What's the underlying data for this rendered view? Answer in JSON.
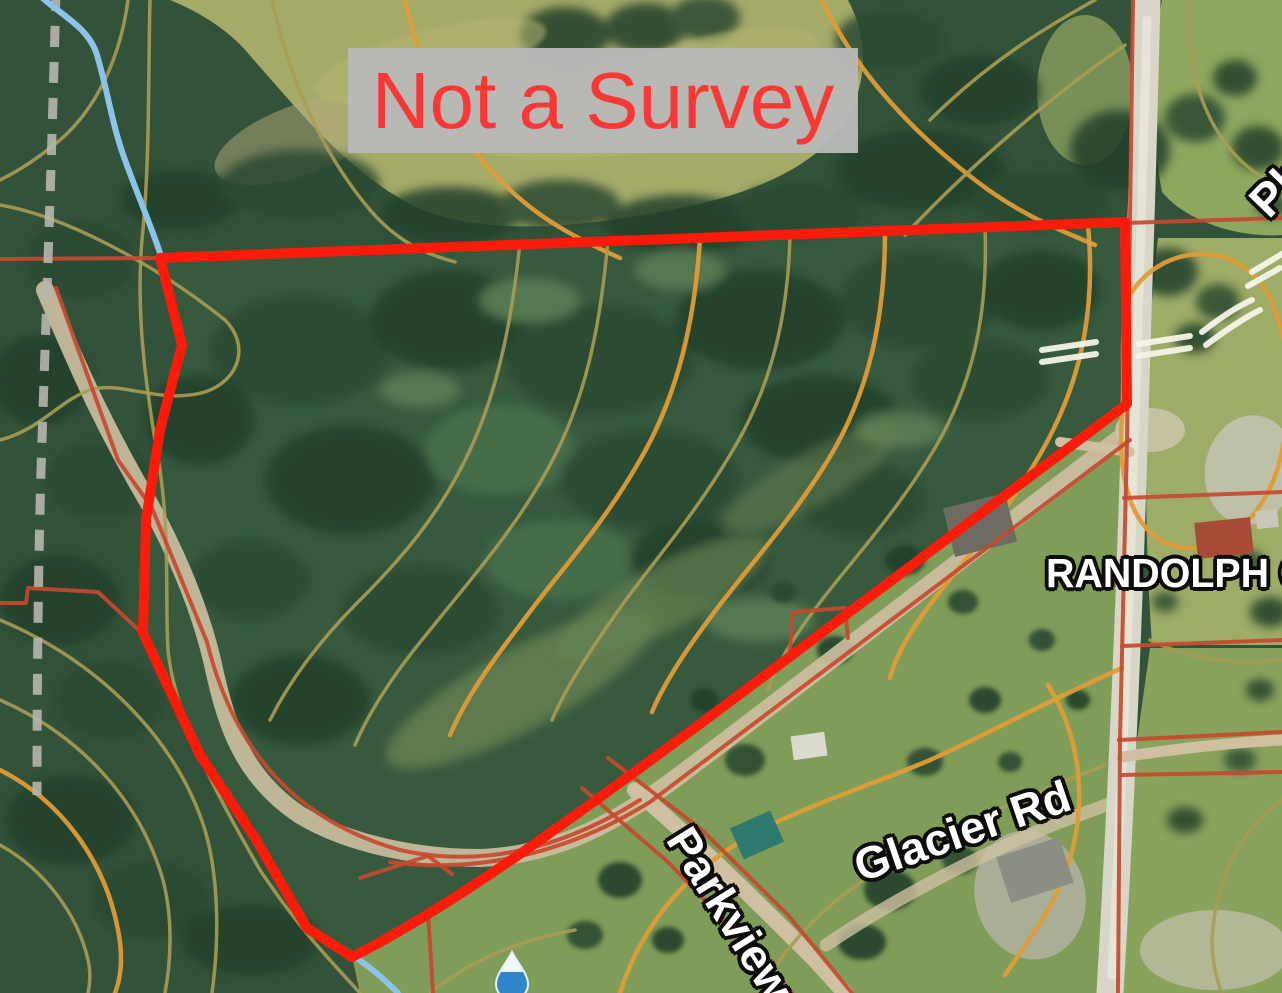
{
  "map": {
    "disclaimer": "Not a Survey",
    "county_label": "RANDOLPH CO",
    "roads": {
      "glacier": "Glacier Rd",
      "parkview": "Parkview",
      "partial_north": "Ph"
    },
    "markers": {
      "water_drop": "water-drop-marker"
    }
  },
  "colors": {
    "boundary-red": "#f91c0a",
    "parcel-red": "#c6492f",
    "contour-orange": "#de9c38",
    "contour-olive": "#a89c54",
    "stream-blue": "#8cc3e9",
    "dashed-gray": "#b7b6ae",
    "road-gray": "#d8d5c9",
    "dirt-tan": "#cec0a1",
    "disclaimer-red": "#fb3434",
    "disclaimer-bg": "#b9b9b9",
    "label-white": "#ffffff",
    "label-outline": "#0d0d0d"
  }
}
